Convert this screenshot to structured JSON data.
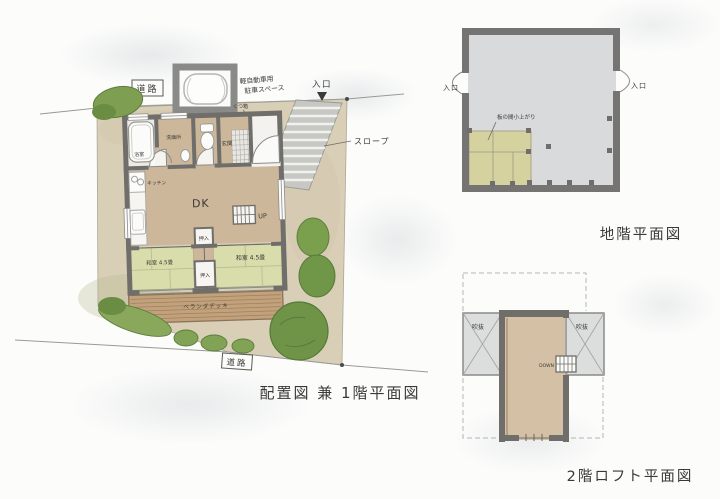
{
  "site": {
    "title": "配置図 兼 1階平面図",
    "road_top": "道路",
    "road_bottom": "道路",
    "parking_line1": "軽自動車用",
    "parking_line2": "駐車スペース",
    "entrance": "入口",
    "entrance_marker": "▼",
    "slope": "スロープ",
    "shoe_cabinet": "くつ箱",
    "deck": "ベランダデッキ"
  },
  "floor1": {
    "bath": "浴室",
    "washroom": "洗面所",
    "genkan": "玄関",
    "kitchen": "キッチン",
    "dk": "DK",
    "up": "UP",
    "closet_upper": "押入",
    "closet_lower": "押入",
    "tatami_left": "和室 4.5畳",
    "tatami_right": "和室 4.5畳"
  },
  "basement": {
    "title": "地階平面図",
    "entrance_left": "入口",
    "entrance_right": "入口",
    "note": "板の間小上がり"
  },
  "loft": {
    "title": "2階ロフト平面図",
    "void_left": "吹抜",
    "void_right": "吹抜",
    "down": "DOWN"
  },
  "colors": {
    "paper": "#fcfcfb",
    "site_ground": "#d8cfb6",
    "floor_wood": "#cdb79b",
    "tatami_green": "#d9dcab",
    "tatami_basement": "#d5d2a0",
    "wall_gray": "#6f6e6a",
    "deck_wood": "#c2a27d",
    "tree_green": "#6f9347",
    "basement_floor": "#d9dadb",
    "void_gray": "#dcdede",
    "slope_gray": "#c7c7c4",
    "ink": "#3b3a36"
  }
}
